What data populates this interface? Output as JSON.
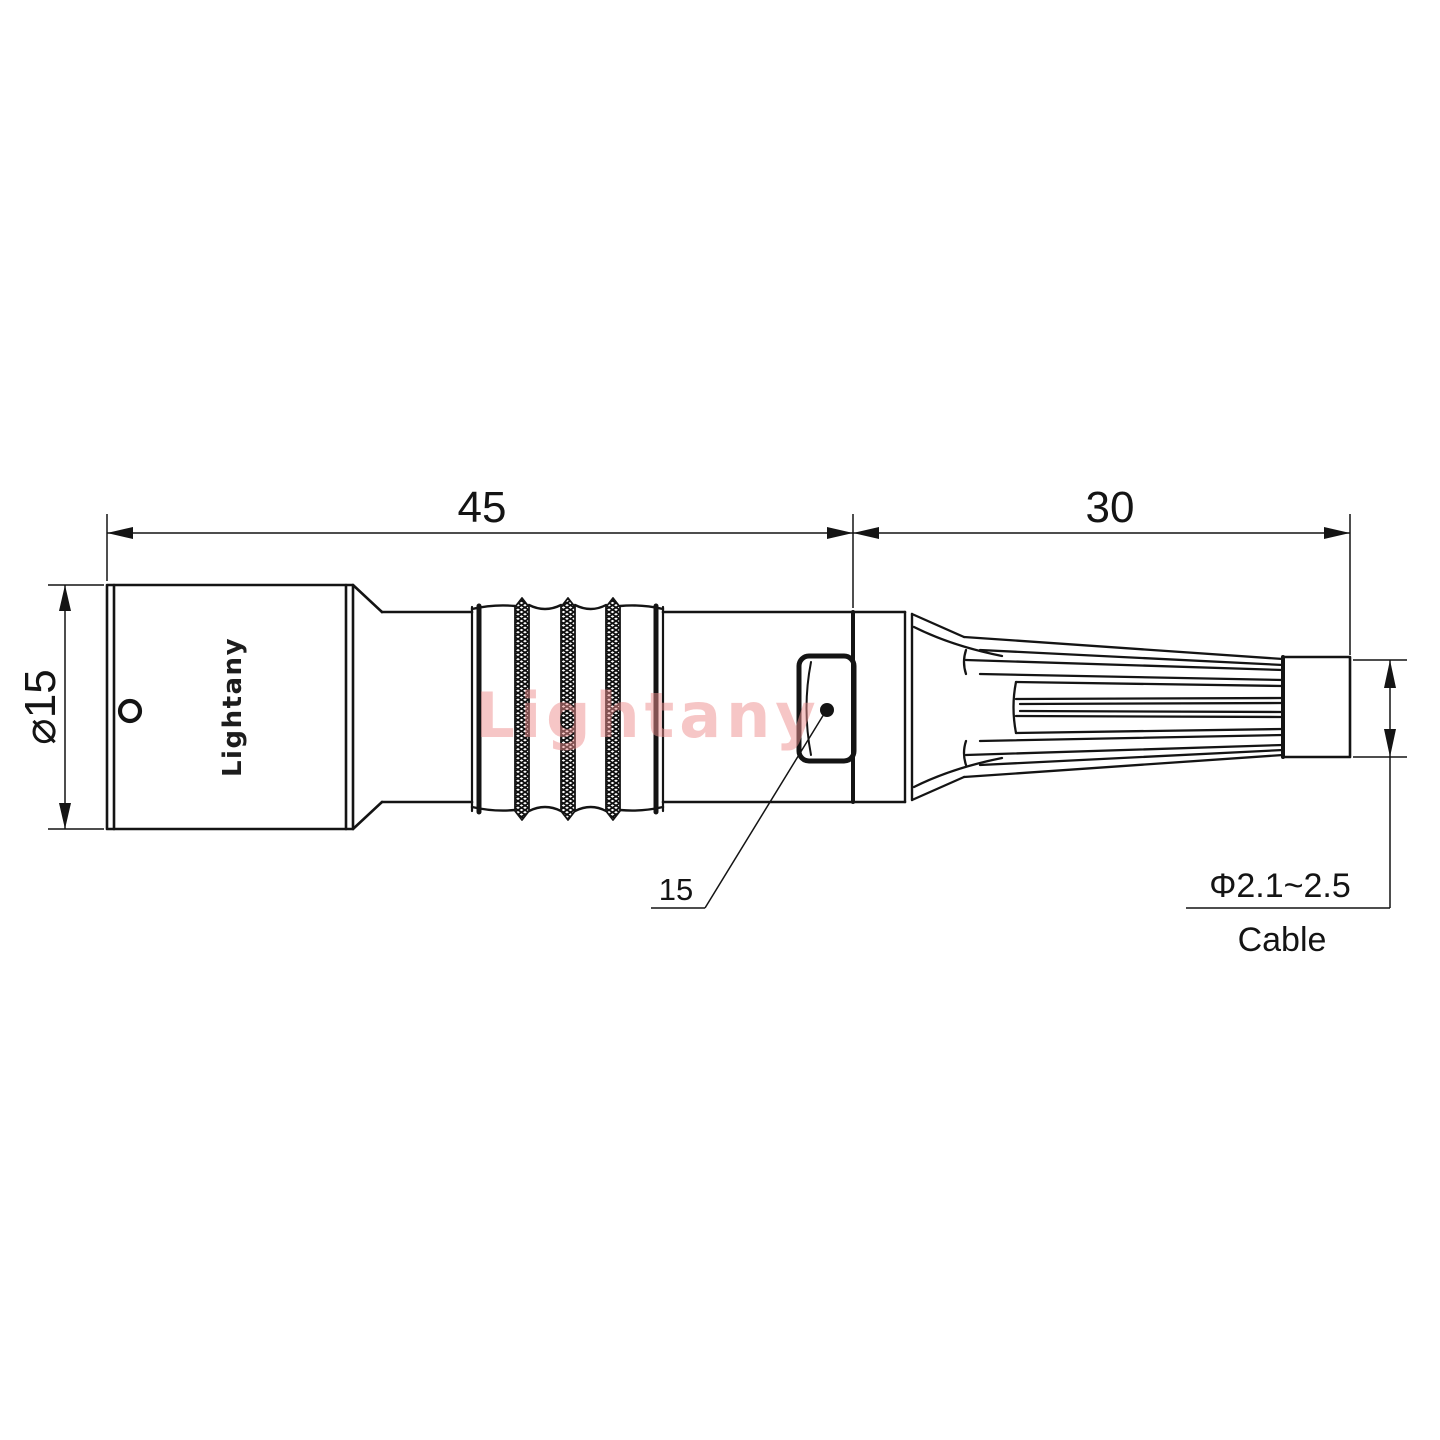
{
  "drawing": {
    "brand_label": "Lightany",
    "watermark_text": "Lightany",
    "dimensions": {
      "front_length": "45",
      "rear_length": "30",
      "body_diameter": "⌀15",
      "nut_leader_label": "15",
      "cable_diameter_range": "Φ2.1~2.5",
      "cable_caption": "Cable"
    },
    "colors": {
      "line": "#141414",
      "watermark": "#ee8f8f",
      "background": "#ffffff"
    }
  }
}
